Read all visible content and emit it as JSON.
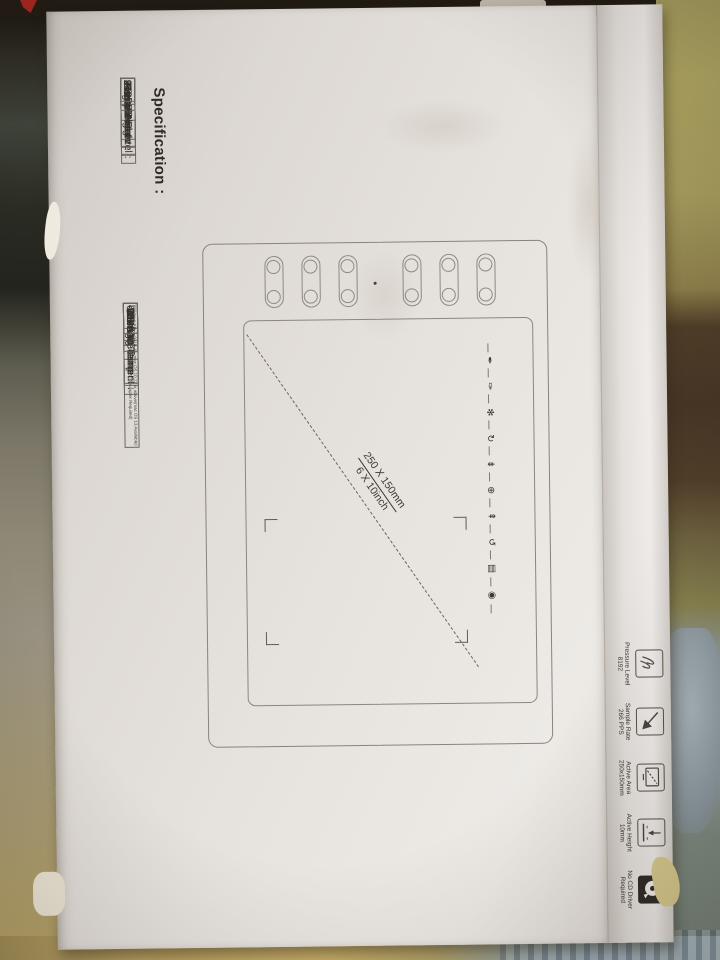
{
  "print": {
    "spec_header": "Specification :",
    "table1": {
      "rows": [
        {
          "label": "Active Area :",
          "value": "250x150mm"
        },
        {
          "label": "Pressure Level :",
          "value": "8192"
        },
        {
          "label": "Sample Rate :",
          "value": "266PPS"
        },
        {
          "label": "Active Height :",
          "value": "15mm"
        },
        {
          "label": "Pen Weight :",
          "value": "9.8g"
        }
      ]
    },
    "table2": {
      "rows": [
        {
          "label": "Interface :",
          "value": "USB"
        },
        {
          "label": "Working Current :",
          "value": "<60mA"
        },
        {
          "label": "Working Temp :",
          "value": "-5~40°C"
        },
        {
          "label": "Storage Temp :",
          "value": "-20~60°C"
        },
        {
          "label": "OS :",
          "value": ""
        }
      ],
      "os_line1": "Windows XP, 7, 8, 10, 11, mac OS 10.12 or above(mac OS 13 Available)",
      "os_line2": "Android 6.0 or above(OTG Adapter Required)"
    },
    "diagram": {
      "size_line1": "250 X 150mm",
      "size_line2": "6 X 10inch",
      "strip_icons": [
        "✒",
        "✑",
        "✻",
        "↻",
        "⇟",
        "⊕",
        "⇞",
        "↺",
        "▤",
        "◉"
      ]
    },
    "side_panel": {
      "items": [
        {
          "line1": "Pressure Level",
          "line2": "8192"
        },
        {
          "line1": "Sample Rate",
          "line2": "266 PPS"
        },
        {
          "line1": "Active Area",
          "line2": "250x150mm"
        },
        {
          "line1": "Active Height",
          "line2": "10mm"
        },
        {
          "line1": "No CD Driver",
          "line2": "Required"
        }
      ]
    }
  },
  "colors": {
    "box_face": "#e6e2de",
    "print_ink": "#3b3835",
    "floor": "#c2a967",
    "curtain_stripes": "#8fa3ad",
    "corner_mark_red": "#a8271f"
  }
}
